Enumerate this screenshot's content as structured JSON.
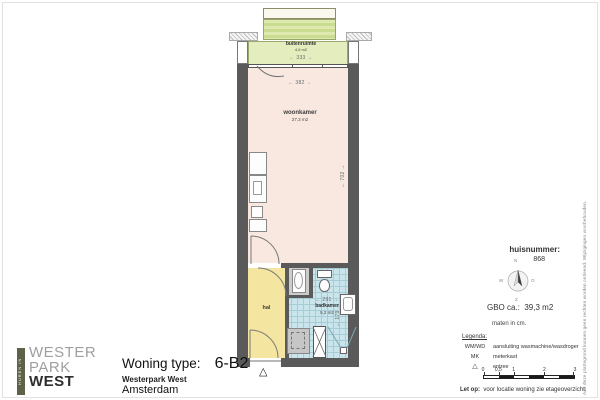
{
  "logo": {
    "vertical": "HUREN IN",
    "line1": "WESTER",
    "line2": "PARK",
    "line3": "WEST"
  },
  "title_block": {
    "label": "Woning type:",
    "value": "6-B2",
    "project": "Westerpark West",
    "city": "Amsterdam"
  },
  "plan": {
    "buitenruimte": {
      "name": "buitenruimte",
      "area": "4,6 m2",
      "dim_w": "← 333 →"
    },
    "woonkamer": {
      "name": "woonkamer",
      "area": "27,3 m2",
      "dim_w": "← 382 →",
      "dim_h": "← 702 →"
    },
    "hal": {
      "name": "hal"
    },
    "badkamer": {
      "name": "badkamer",
      "area": "5,2 m2",
      "dim_w": "← 291 →",
      "dim_h": "← 179 →"
    },
    "entree_marker": "△"
  },
  "sidebar": {
    "huisnummer_label": "huisnummer:",
    "huisnummer_value": "868",
    "compass": {
      "n": "N",
      "o": "O",
      "z": "Z",
      "w": "W"
    },
    "gbo_label": "GBO ca.:",
    "gbo_value": "39,3 m2",
    "units": "maten in cm.",
    "legend_title": "Legenda:",
    "legend": [
      {
        "key": "WM/WD",
        "desc": "aansluiting wasmachine/wasdroger"
      },
      {
        "key": "MK",
        "desc": "meterkast"
      },
      {
        "key": "△",
        "desc": "entree"
      }
    ],
    "scale_labels": [
      "0",
      "0,5",
      "1",
      "2",
      "3"
    ],
    "note_label": "Let op:",
    "note": "voor locatie woning zie etageoverzicht.",
    "disclaimer": "Aan deze plattegrond kunnen geen rechten worden ontleend. Wijzigingen voorbehouden."
  },
  "colors": {
    "wall": "#5a5a5a",
    "woonkamer": "#f9e8e0",
    "hal": "#f4e5a1",
    "badkamer": "#c9e4ea",
    "buitenruimte": "#e3edbd",
    "logo_bar": "#5f6247"
  }
}
